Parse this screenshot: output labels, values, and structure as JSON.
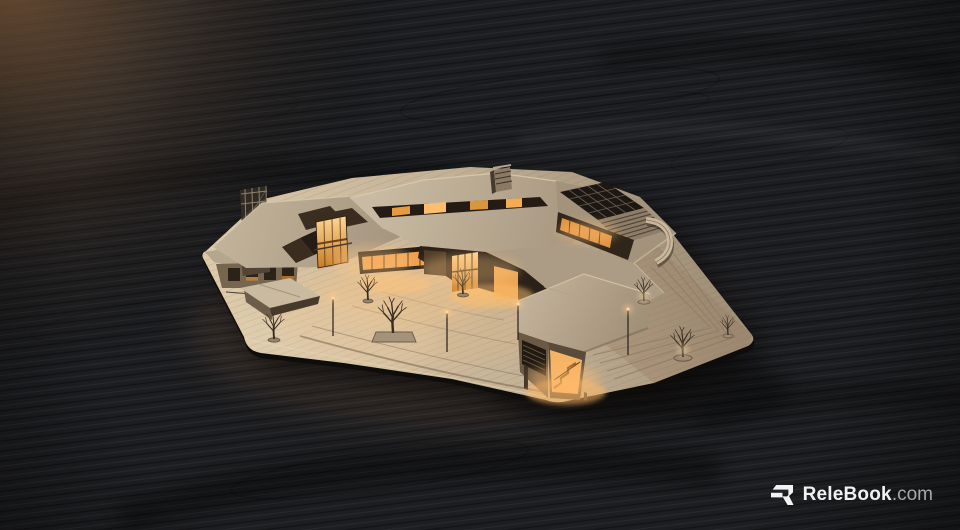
{
  "watermark": {
    "brand": "ReleBook",
    "suffix": ".com",
    "logo_icon": "relebook-r-icon"
  },
  "scene": {
    "subject": "wooden architectural scale model with warmly lit interiors standing on a dark wood-grain table",
    "elements": [
      "dark-wood-table",
      "model-baseboard",
      "swooping-roof-canopy",
      "clerestory-window-band",
      "skylight-grid-roof",
      "louvered-roof",
      "corner-tower",
      "lit-pavilions",
      "stair-pavilion",
      "gabled-kiosk",
      "courtyard-plaza",
      "terrace-path-lines",
      "bare-trees",
      "tree-planters",
      "light-poles",
      "warm-interior-glow"
    ]
  },
  "colors": {
    "background": "#1d1e21",
    "corner_light": "#b07c4f",
    "base_wood": "#c9b79d",
    "roof_wood": "#bcae98",
    "facade_wood": "#6f5e4a",
    "dark_opening": "#241c14",
    "window_glow": "#ffb35a",
    "tree": "#382d23",
    "watermark_text": "#f0f1f1",
    "watermark_suffix": "#a6a8aa"
  }
}
